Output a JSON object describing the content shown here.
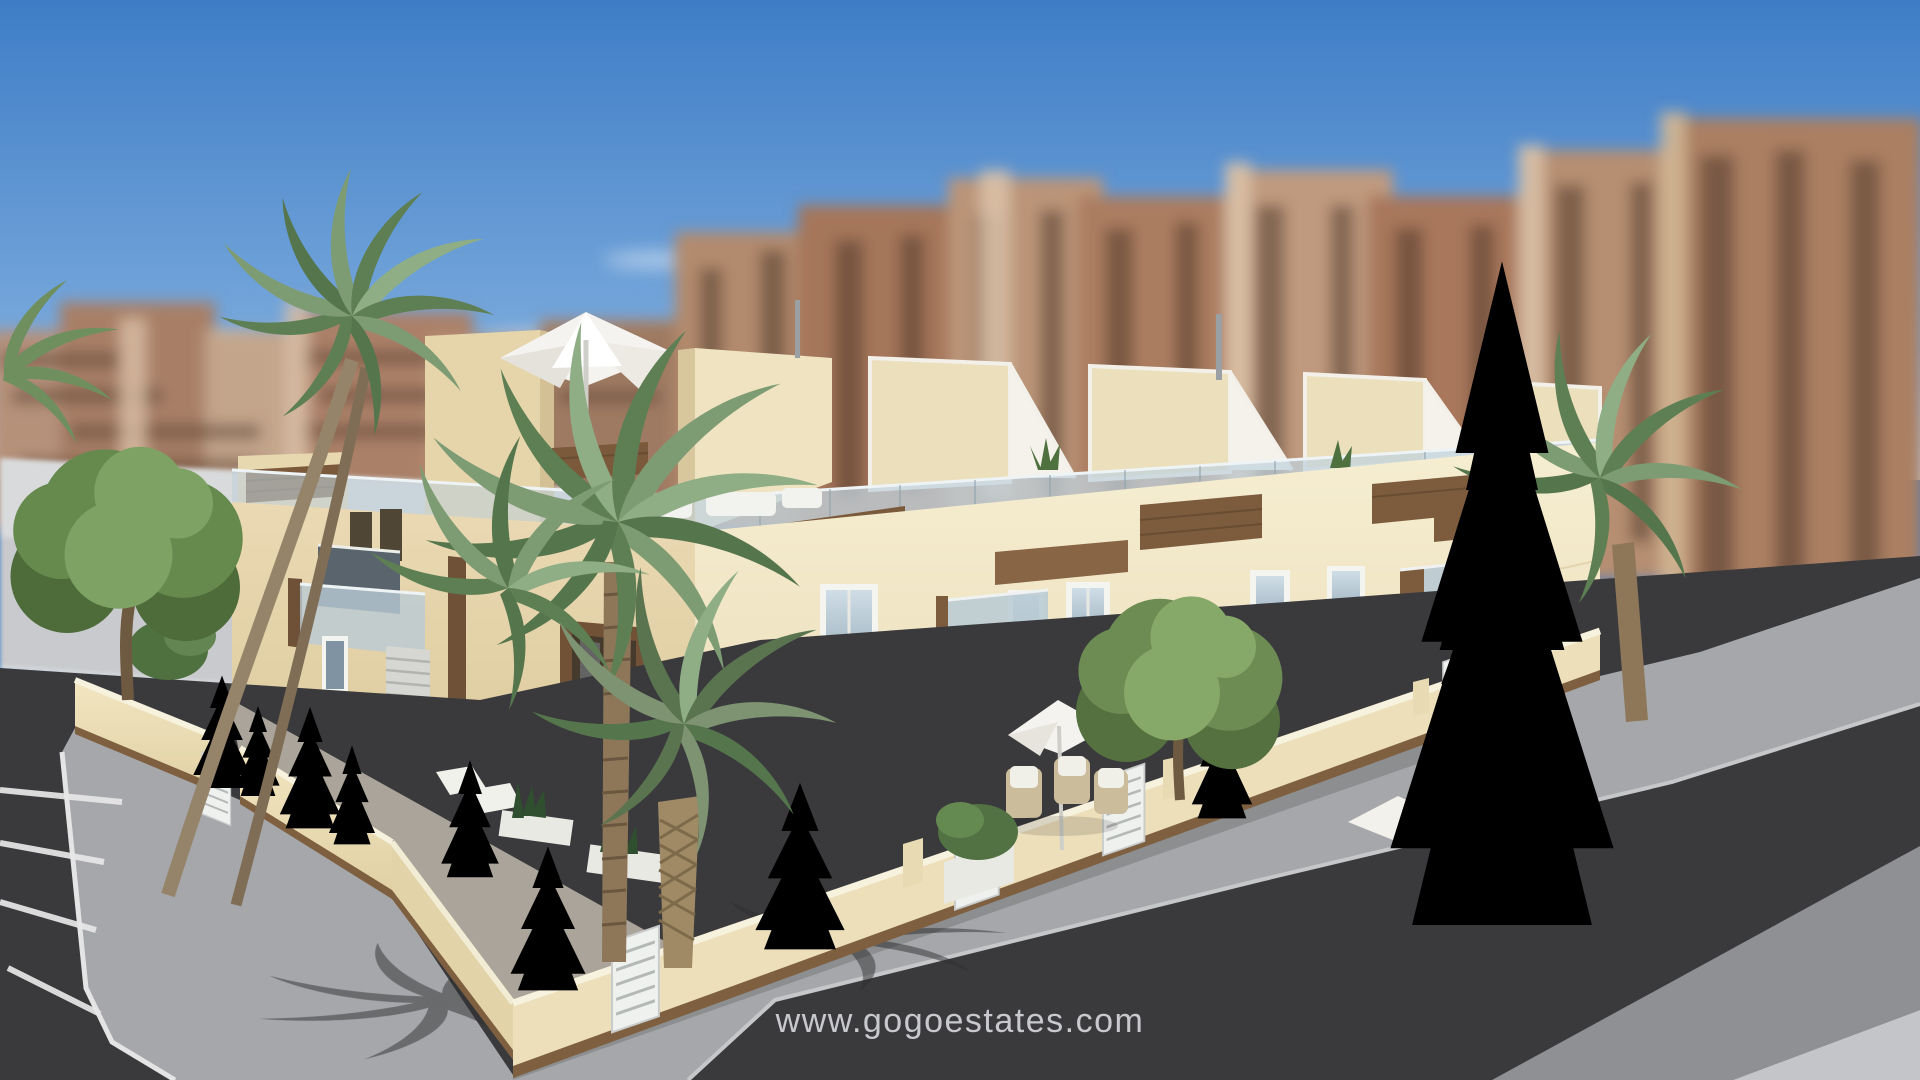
{
  "scene": {
    "type": "3d-architectural-rendering",
    "subject": "Modern two-storey corner townhouse complex with set-back roof terraces, cream stucco facades, timber-clad balcony accents, glass balustrades, landscaped walled front gardens with palms and conifers, street-corner parking bays and roads in the foreground, blurred high-rise apartment blocks behind under a clear blue sky"
  },
  "watermark": {
    "text": "www.gogoestates.com"
  },
  "palette": {
    "sky_top": "#3E7DC6",
    "sky_horizon": "#C6DAEC",
    "cloud": "#FFFFFF",
    "background_buildings": "#AD8468",
    "background_building_shadow": "#5E4434",
    "facade_sunlit": "#F2E8CA",
    "facade_shaded": "#E0CFA5",
    "wood_accent": "#7B5A3C",
    "window_glass": "#A8BCC9",
    "window_frame": "#F4F4F1",
    "roof_terrace_glass": "#C2D3DD",
    "pergola_white": "#F4F2EA",
    "garden_wall": "#ECDFBA",
    "wall_coping": "#F7F2DD",
    "wall_plinth": "#7E5F40",
    "gate_white": "#EFF1EF",
    "grass": "#6D8F55",
    "tree_foliage": "#66894E",
    "conifer": "#3F6039",
    "palm_frond": "#7C9A72",
    "palm_trunk": "#8D7758",
    "plaza": "#C8CACD",
    "sidewalk": "#A6A7AA",
    "asphalt": "#3A3A3D",
    "road_marking": "#E8E8E8"
  }
}
